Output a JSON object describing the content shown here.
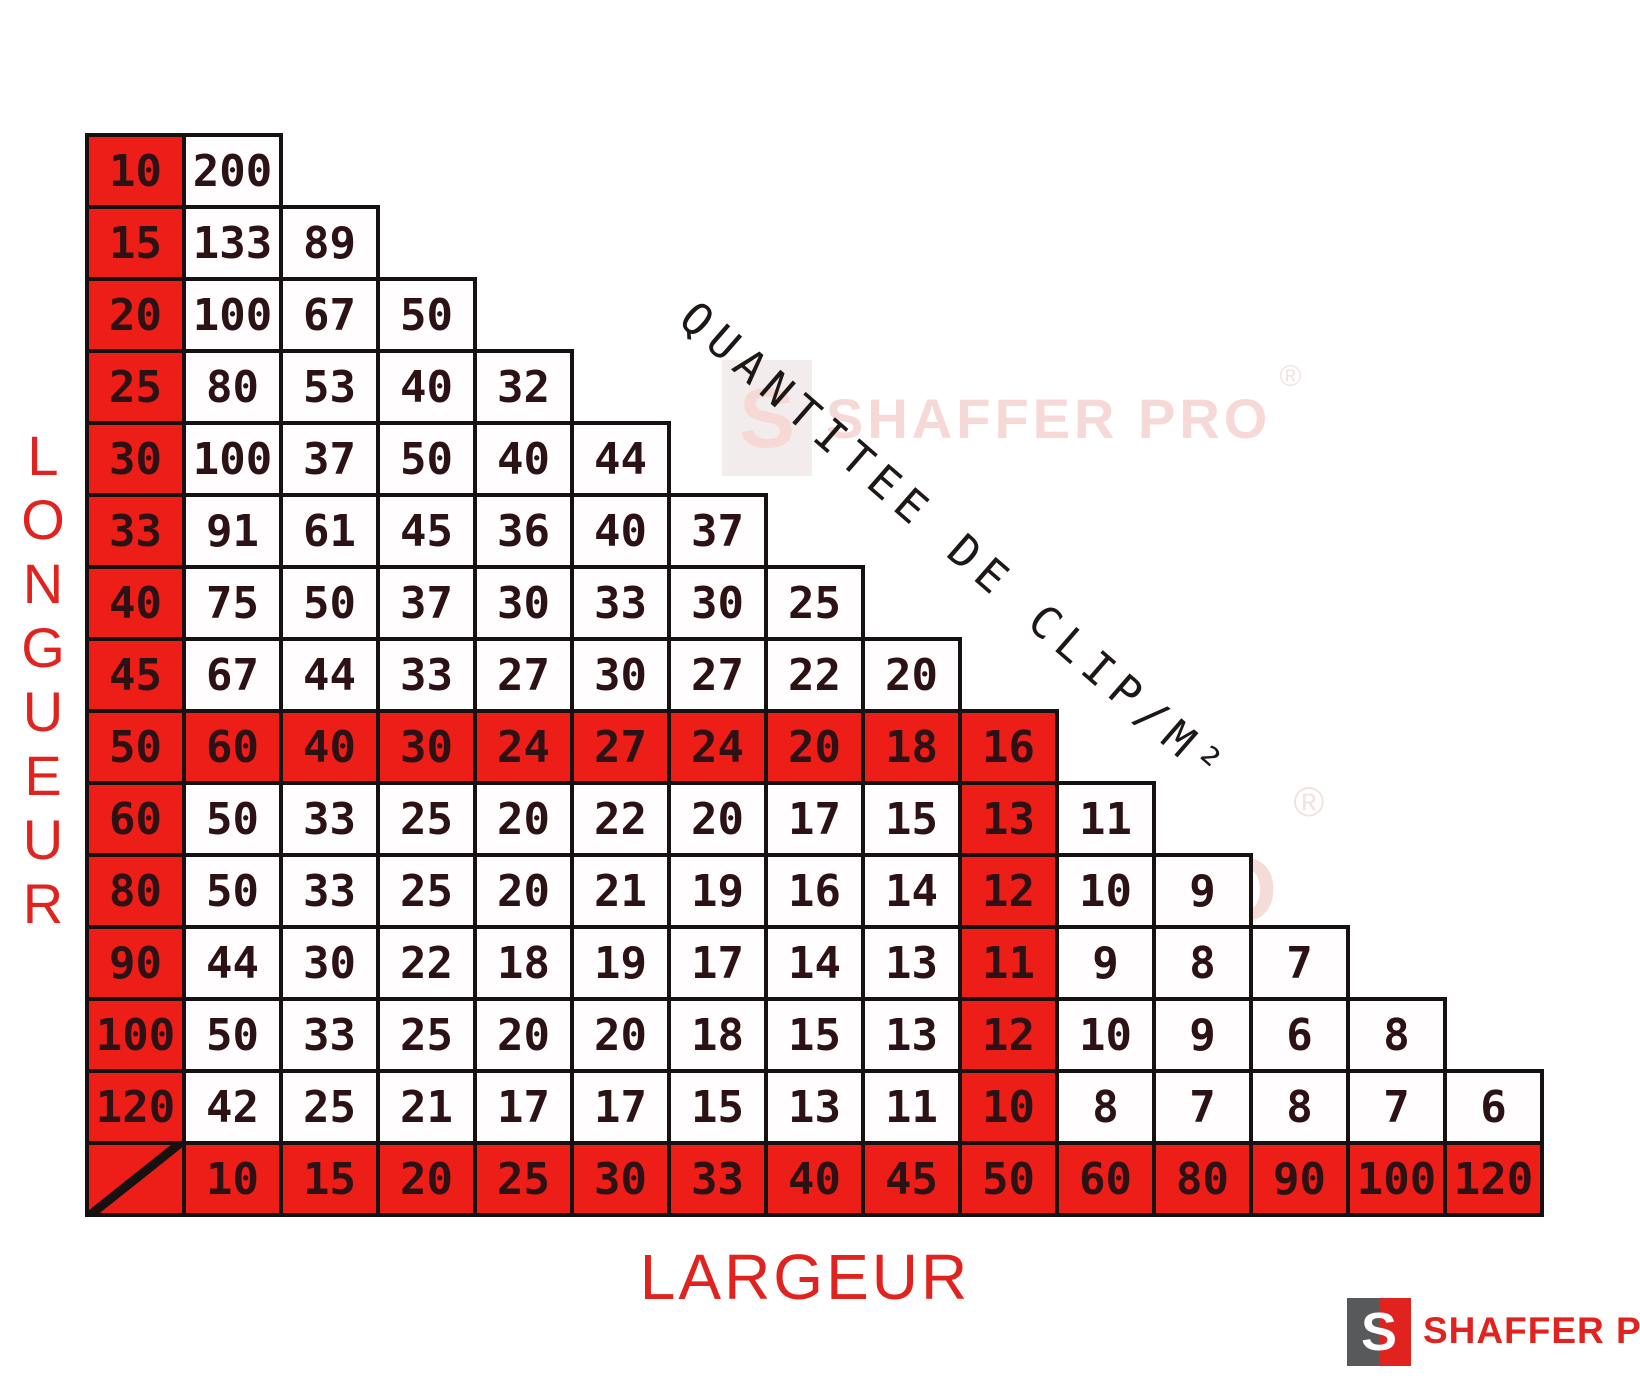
{
  "title_diagonal": "QUANTITEE DE CLIP/M²",
  "axis": {
    "left": "LONGUEUR",
    "bottom": "LARGEUR"
  },
  "brand": {
    "name": "SHAFFER PRO",
    "registered": "®",
    "monogram": "S"
  },
  "colors": {
    "highlight_red": "#ed1d18",
    "cell_text": "#2c1214",
    "border_black": "#171111",
    "axis_red": "#e0231f",
    "brand_grey": "#58595b",
    "watermark_pink": "#f6d9d6"
  },
  "chart_data": {
    "type": "table",
    "title": "QUANTITEE DE CLIP/M²",
    "x_axis_label": "LARGEUR",
    "y_axis_label": "LONGUEUR",
    "columns": [
      10,
      15,
      20,
      25,
      30,
      33,
      40,
      45,
      50,
      60,
      80,
      90,
      100,
      120
    ],
    "rows": [
      {
        "longueur": 10,
        "values": [
          200
        ]
      },
      {
        "longueur": 15,
        "values": [
          133,
          89
        ]
      },
      {
        "longueur": 20,
        "values": [
          100,
          67,
          50
        ]
      },
      {
        "longueur": 25,
        "values": [
          80,
          53,
          40,
          32
        ]
      },
      {
        "longueur": 30,
        "values": [
          100,
          37,
          50,
          40,
          44
        ]
      },
      {
        "longueur": 33,
        "values": [
          91,
          61,
          45,
          36,
          40,
          37
        ]
      },
      {
        "longueur": 40,
        "values": [
          75,
          50,
          37,
          30,
          33,
          30,
          25
        ]
      },
      {
        "longueur": 45,
        "values": [
          67,
          44,
          33,
          27,
          30,
          27,
          22,
          20
        ]
      },
      {
        "longueur": 50,
        "values": [
          60,
          40,
          30,
          24,
          27,
          24,
          20,
          18,
          16
        ]
      },
      {
        "longueur": 60,
        "values": [
          50,
          33,
          25,
          20,
          22,
          20,
          17,
          15,
          13,
          11
        ]
      },
      {
        "longueur": 80,
        "values": [
          50,
          33,
          25,
          20,
          21,
          19,
          16,
          14,
          12,
          10,
          9
        ]
      },
      {
        "longueur": 90,
        "values": [
          44,
          30,
          22,
          18,
          19,
          17,
          14,
          13,
          11,
          9,
          8,
          7
        ]
      },
      {
        "longueur": 100,
        "values": [
          50,
          33,
          25,
          20,
          20,
          18,
          15,
          13,
          12,
          10,
          9,
          6,
          8
        ]
      },
      {
        "longueur": 120,
        "values": [
          42,
          25,
          21,
          17,
          17,
          15,
          13,
          11,
          10,
          8,
          7,
          8,
          7,
          6
        ]
      }
    ],
    "highlight": {
      "row_longueur": 50,
      "column_largeur": 50
    },
    "legend_position": "none",
    "grid": true
  }
}
